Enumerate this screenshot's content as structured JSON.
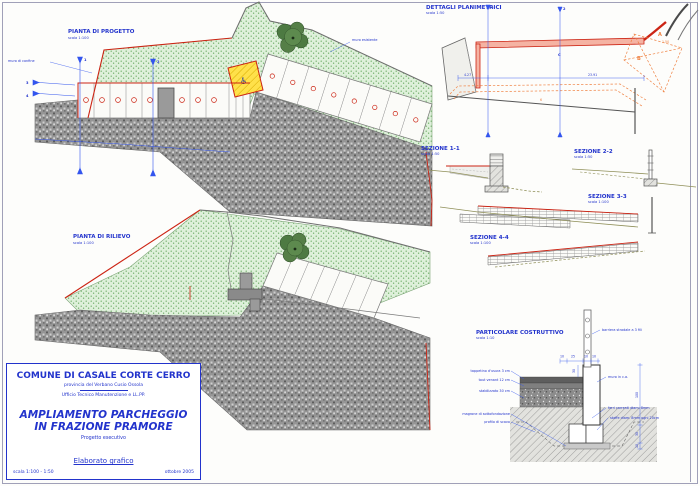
{
  "plan_progetto": {
    "title": "PIANTA DI PROGETTO",
    "scale": "scala 1:100",
    "label_boundary_wall": "muro di confine",
    "label_existing_wall": "muro esistente",
    "marks": {
      "m1": "1",
      "m2": "2",
      "m3": "3",
      "m4": "4"
    }
  },
  "plan_rilievo": {
    "title": "PIANTA DI RILIEVO",
    "scale": "scala 1:100"
  },
  "detail_plan": {
    "title": "DETTAGLI PLANIMETRICI",
    "scale": "scala 1:50",
    "dim_left": "4.27",
    "dim_right": "23.91",
    "dim_corner": "1.50",
    "zone_a": "A",
    "zone_b": "B",
    "zone_c": "C",
    "note_6": "6",
    "mark_1": "1",
    "mark_2": "2"
  },
  "sections": [
    {
      "title": "SEZIONE 1-1",
      "scale": "scala 1:50"
    },
    {
      "title": "SEZIONE 2-2",
      "scale": "scala 1:50"
    },
    {
      "title": "SEZIONE 3-3",
      "scale": "scala 1:100"
    },
    {
      "title": "SEZIONE 4-4",
      "scale": "scala 1:100"
    }
  ],
  "construction_detail": {
    "title": "PARTICOLARE COSTRUTTIVO",
    "scale": "scala 1:10",
    "labels": {
      "barrier": "barriera stradale a 3 fili",
      "wall": "muro in c.a.",
      "rebar": "ferri correnti diam. 8mm",
      "stirrups": "staffe diam. 8mm ogni 20cm",
      "wear_layer": "tappetino d'usura 3 cm",
      "tout_venant": "tout venant 12 cm",
      "stabilized": "stabilizzato 30 cm",
      "lean_concrete": "magrone di sottofondazione",
      "excavation": "profilo di scavo"
    },
    "dims": {
      "t10a": "10",
      "t25": "25",
      "t10b": "10",
      "t10c": "10",
      "h30": "30",
      "h100": "100",
      "f30": "30",
      "m10": "10"
    }
  },
  "title_block": {
    "municipality": "COMUNE DI CASALE CORTE CERRO",
    "province": "provincia del Verbano Cusio Ossola",
    "office": "Ufficio Tecnico Manutenzione e LL.PP.",
    "project_title_line1": "AMPLIAMENTO PARCHEGGIO",
    "project_title_line2": "IN FRAZIONE PRAMORE",
    "subtitle": "Progetto esecutivo",
    "doc_type": "Elaborato grafico",
    "scales": "scala 1:100 - 1:50",
    "date": "ottobre 2005"
  },
  "icons": {
    "disabled_parking": "♿"
  },
  "colors": {
    "cad_blue": "#2233cc",
    "cad_red": "#cc2414",
    "cad_orange": "#ef8040",
    "grass": "#def0da",
    "asphalt": "#939393",
    "olive": "#8f8f58",
    "yellow": "#ffe14a"
  }
}
